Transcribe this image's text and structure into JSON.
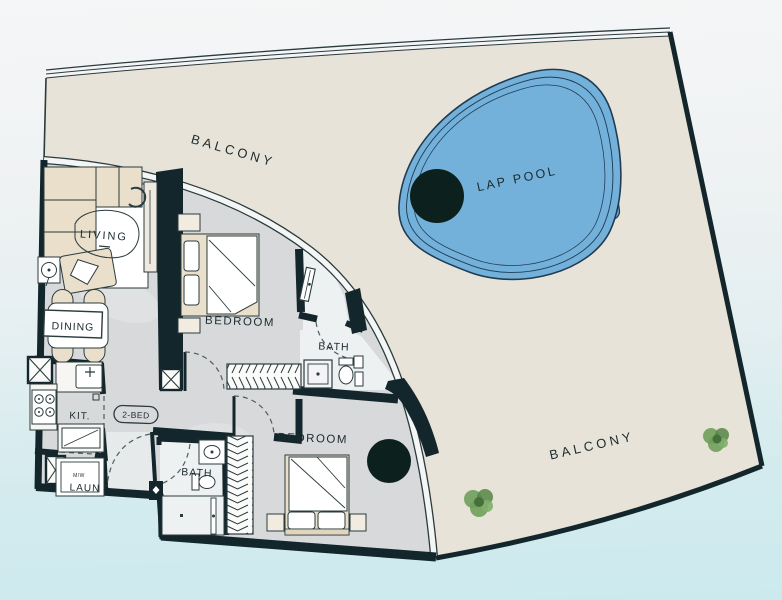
{
  "labels": {
    "balcony_top": "BALCONY",
    "balcony_bottom": "BALCONY",
    "lap_pool": "LAP POOL",
    "living": "LIVING",
    "dining": "DINING",
    "kitchen": "KIT.",
    "unit_type": "2-BED",
    "laundry": "LAUN",
    "laundry_machine": "M/W",
    "bedroom_1": "BEDROOM",
    "bath_1": "BATH",
    "bedroom_2": "BEDROOM",
    "bath_2": "BATH"
  },
  "colors": {
    "balcony": "#e8e3d8",
    "floor": "#d8d9db",
    "marble": "#eef1f2",
    "wall": "#13262b",
    "line": "#2b3b3e",
    "pool": "#74b1da",
    "pool-line": "#1e3d55",
    "pool-dark": "#0c211d",
    "furniture": "#eadfca",
    "plant": "#6f9e5b",
    "plant-dark": "#578547",
    "label": "#1b2b2e"
  }
}
